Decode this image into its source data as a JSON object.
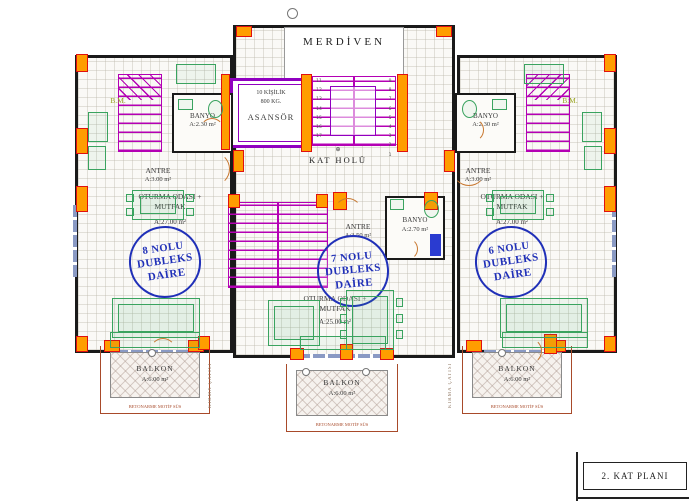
{
  "colors": {
    "stair_magenta": "#b400b4",
    "elevator_purple": "#9000c0",
    "column_orange": "#ff9d00",
    "column_red": "#e01010",
    "furniture_green": "#3aa35f",
    "stamp_blue": "#2030b8",
    "balcony_brown": "#a84a2a",
    "appliance_blue": "#2a3bd0"
  },
  "title_block": {
    "label": "2. KAT PLANI"
  },
  "core": {
    "merdiven": "MERDİVEN",
    "asansor_capacity": "10 KİŞİLİK",
    "asansor_weight": "800 KG.",
    "asansor_name": "ASANSÖR",
    "kat_holu": "KAT HOLÜ",
    "steps_left": [
      "11",
      "12",
      "13",
      "14",
      "15",
      "16",
      "17"
    ],
    "steps_right": [
      "9",
      "8",
      "7",
      "6",
      "5",
      "4",
      "3",
      "2",
      "1"
    ]
  },
  "units": [
    {
      "stamp_line1": "8 NOLU",
      "stamp_line2": "DUBLEKS",
      "stamp_line3": "DAİRE",
      "antre_name": "ANTRE",
      "antre_area": "A:3.00 m²",
      "banyo_name": "BANYO",
      "banyo_area": "A:2.30 m²",
      "living_line1": "OTURMA ODASI +",
      "living_line2": "MUTFAK",
      "living_area": "A:27.00 m²",
      "bm_label": "B.M."
    },
    {
      "stamp_line1": "7 NOLU",
      "stamp_line2": "DUBLEKS",
      "stamp_line3": "DAİRE",
      "antre_name": "ANTRE",
      "antre_area": "A:3.50 m²",
      "banyo_name": "BANYO",
      "banyo_area": "A:2.70 m²",
      "living_line1": "OTURMA ODASI +",
      "living_line2": "MUTFAK",
      "living_area": "A:25.00 m²"
    },
    {
      "stamp_line1": "6 NOLU",
      "stamp_line2": "DUBLEKS",
      "stamp_line3": "DAİRE",
      "antre_name": "ANTRE",
      "antre_area": "A:3.00 m²",
      "banyo_name": "BANYO",
      "banyo_area": "A:2.30 m²",
      "living_line1": "OTURMA ODASI +",
      "living_line2": "MUTFAK",
      "living_area": "A:27.00 m²",
      "bm_label": "B.M."
    }
  ],
  "balcony": {
    "name": "BALKON",
    "area": "A:6.00 m²",
    "railing_note": "BETONARME MOTİF SÜS"
  },
  "annotations": {
    "roof_note": "KIRMA ÇATISI"
  }
}
